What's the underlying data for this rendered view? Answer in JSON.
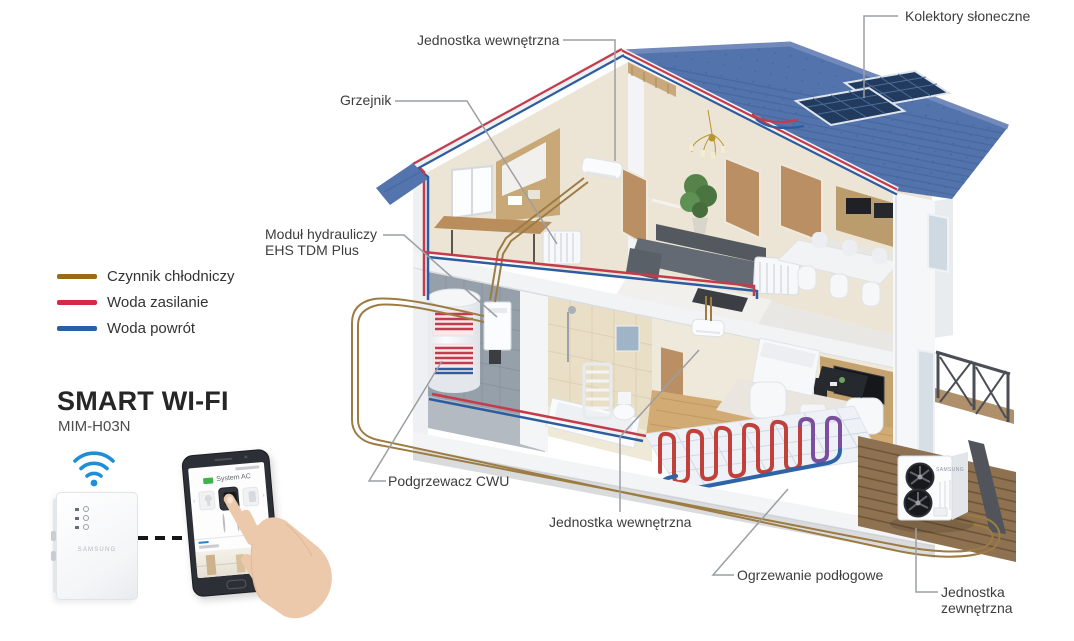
{
  "legend": {
    "items": [
      {
        "label": "Czynnik chłodniczy",
        "color": "#9a6b15"
      },
      {
        "label": "Woda zasilanie",
        "color": "#d22b45"
      },
      {
        "label": "Woda powrót",
        "color": "#2a5fa5"
      }
    ]
  },
  "product": {
    "title": "SMART WI-FI",
    "model": "MIM-H03N",
    "device_brand": "SAMSUNG",
    "app_title": "System AC"
  },
  "callouts": {
    "solar_collectors": "Kolektory słoneczne",
    "indoor_unit_top": "Jednostka wewnętrzna",
    "radiator": "Grzejnik",
    "hydraulic_module_line1": "Moduł hydrauliczy",
    "hydraulic_module_line2": "EHS TDM Plus",
    "dhw_heater": "Podgrzewacz CWU",
    "indoor_unit_bottom": "Jednostka wewnętrzna",
    "floor_heating": "Ogrzewanie podłogowe",
    "outdoor_unit_line1": "Jednostka",
    "outdoor_unit_line2": "zewnętrzna"
  },
  "colors": {
    "refrigerant": "#9a6b15",
    "water_supply": "#d22b45",
    "water_return": "#2a5fa5",
    "roof": "#5373ac",
    "wifi": "#1e8fd5",
    "label_text": "#3d3d3d",
    "leader_line": "#9b9fa3"
  }
}
